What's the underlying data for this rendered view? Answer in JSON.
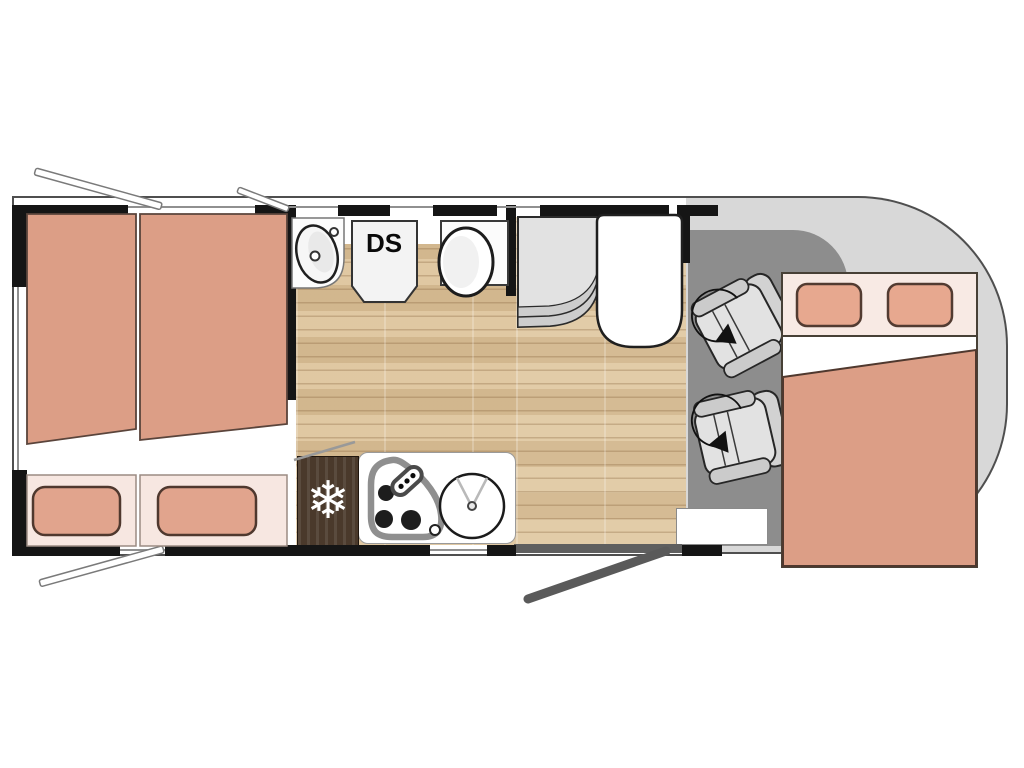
{
  "plan": {
    "title": "Motorhome floor plan (top view)",
    "labels": {
      "shower": "DS"
    },
    "icons": {
      "fridge_snowflake": "❄"
    },
    "colors": {
      "wall": "#151515",
      "body_outline": "#4f4f4f",
      "wood_floor": "#d9bf97",
      "wood_floor_light": "#dcc49e",
      "bedding_salmon": "#dc9e86",
      "pillow": "#e1a48d",
      "pillow_strip": "#f7e7e1",
      "cab_body": "#d8d8d8",
      "cab_floor": "#8d8d8d",
      "fridge_wood": "#4a392b",
      "door_gray": "#5f5f5f",
      "seat_gray": "#e2e2e2",
      "fixture_white": "#ffffff"
    }
  }
}
